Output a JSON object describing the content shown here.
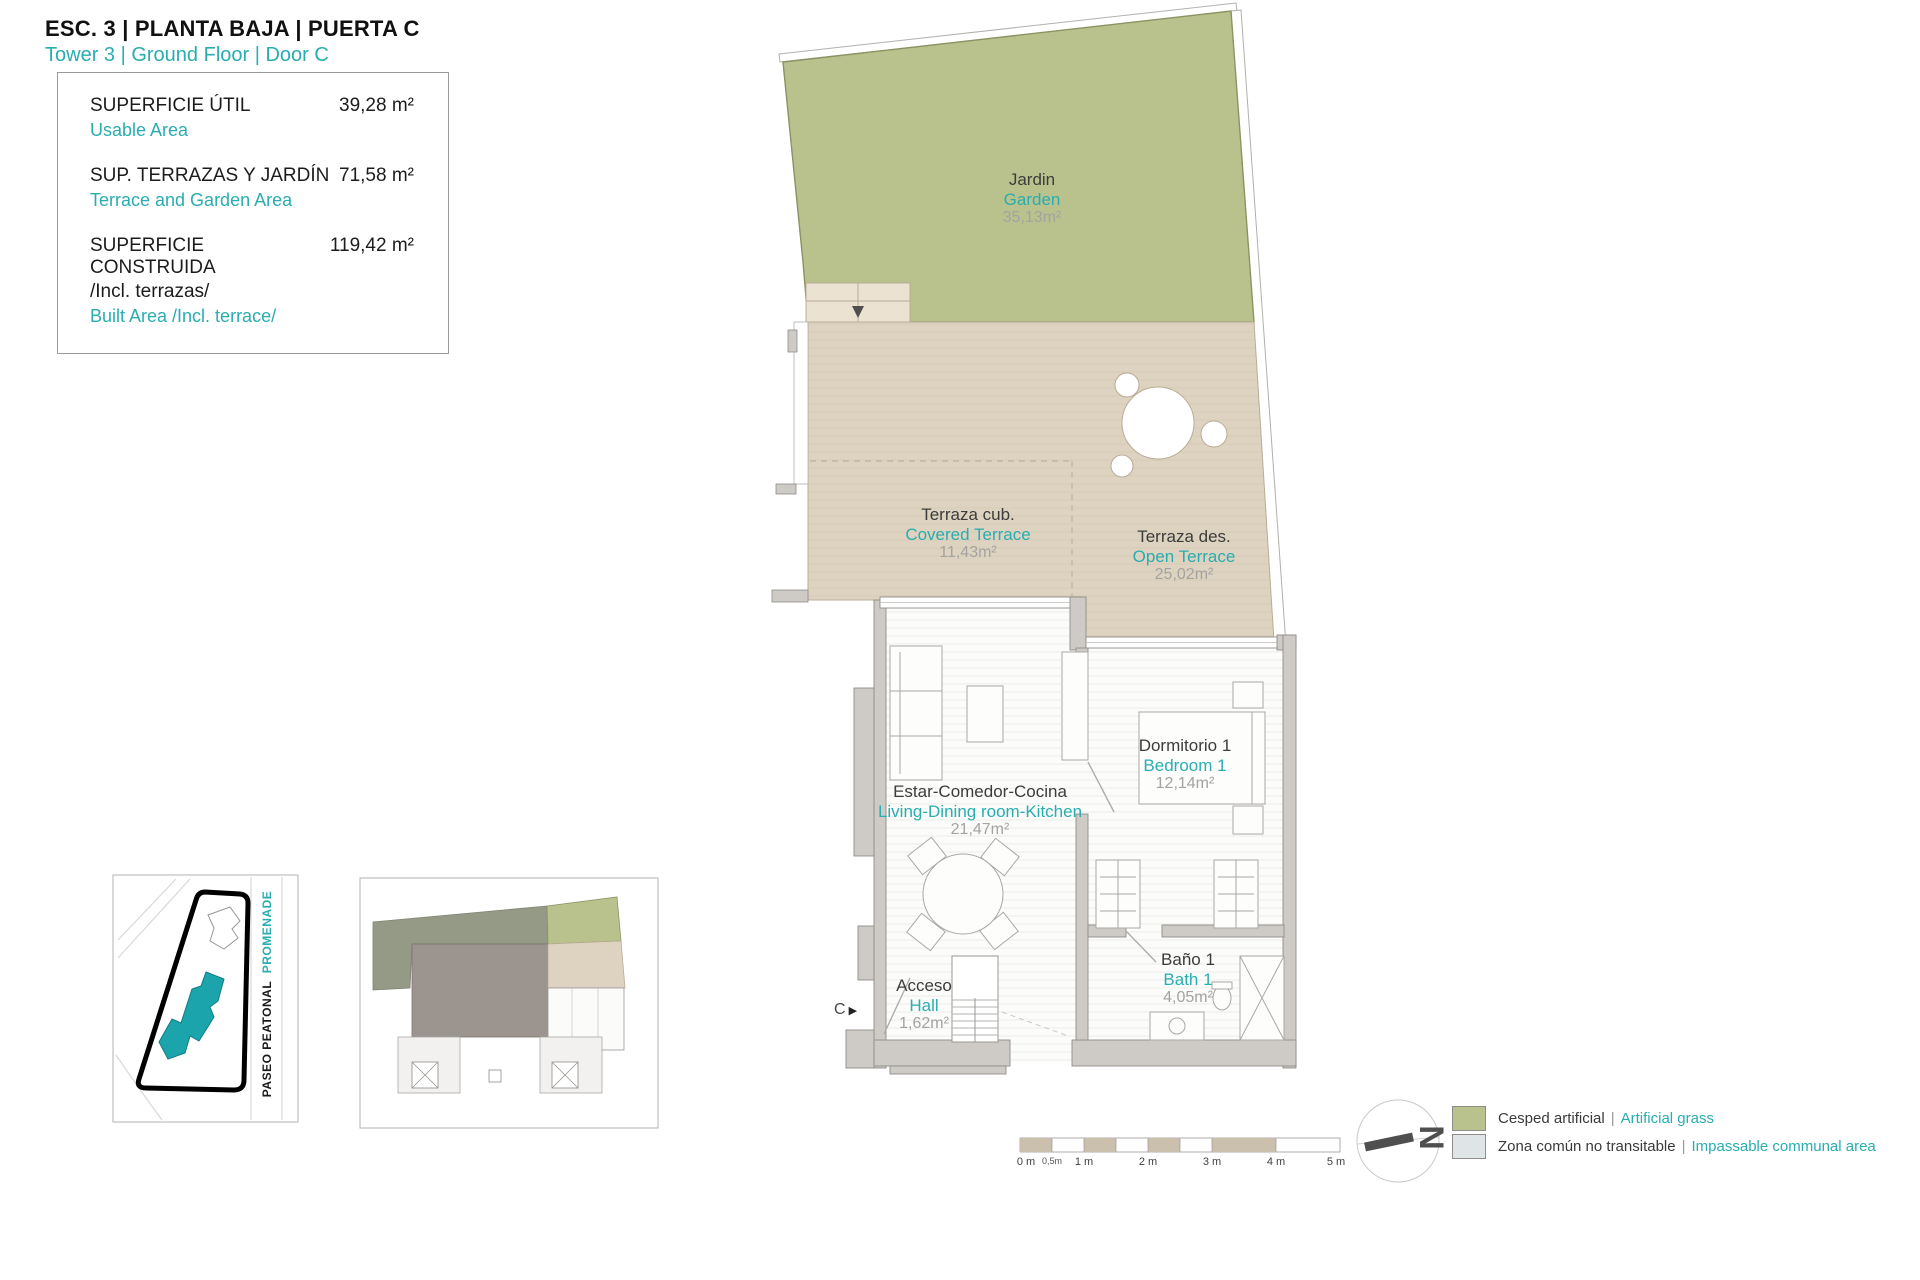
{
  "header": {
    "title": "ESC. 3 | PLANTA BAJA | PUERTA C",
    "subtitle": "Tower 3 | Ground Floor | Door C"
  },
  "info_box": {
    "rows": [
      {
        "label": "SUPERFICIE ÚTIL",
        "value": "39,28 m²",
        "label_en": "Usable Area"
      },
      {
        "label": "SUP. TERRAZAS Y JARDÍN",
        "value": "71,58 m²",
        "label_en": "Terrace and Garden Area"
      },
      {
        "label": "SUPERFICIE CONSTRUIDA",
        "value": "119,42 m²",
        "label_extra": "/Incl. terrazas/",
        "label_en": "Built Area /Incl. terrace/"
      }
    ]
  },
  "rooms": [
    {
      "name": "Jardin",
      "name_en": "Garden",
      "area": "35,13m²"
    },
    {
      "name": "Terraza cub.",
      "name_en": "Covered Terrace",
      "area": "11,43m²"
    },
    {
      "name": "Terraza des.",
      "name_en": "Open Terrace",
      "area": "25,02m²"
    },
    {
      "name": "Estar-Comedor-Cocina",
      "name_en": "Living-Dining room-Kitchen",
      "area": "21,47m²"
    },
    {
      "name": "Dormitorio 1",
      "name_en": "Bedroom 1",
      "area": "12,14m²"
    },
    {
      "name": "Baño 1",
      "name_en": "Bath 1",
      "area": "4,05m²"
    },
    {
      "name": "Acceso",
      "name_en": "Hall",
      "area": "1,62m²"
    }
  ],
  "entrance": {
    "door_label": "C",
    "door_icon": "▶"
  },
  "site_plan": {
    "street": "PASEO PEATONAL",
    "street_en": "PROMENADE"
  },
  "compass": {
    "north": "N"
  },
  "scale_bar": {
    "ticks": [
      "0 m",
      "0,5m",
      "1 m",
      "2 m",
      "3 m",
      "4 m",
      "5 m"
    ]
  },
  "legend": {
    "separator": "|",
    "items": [
      {
        "label": "Cesped artificial",
        "label_en": "Artificial grass",
        "color": "#b9c28d"
      },
      {
        "label": "Zona común no transitable",
        "label_en": "Impassable communal area",
        "color": "#dfe5e7"
      }
    ]
  },
  "colors": {
    "accent": "#29adb1",
    "garden": "#b9c28d",
    "terrace": "#ded3c0",
    "wall": "#cecbc7",
    "communal": "#dfe5e7"
  }
}
